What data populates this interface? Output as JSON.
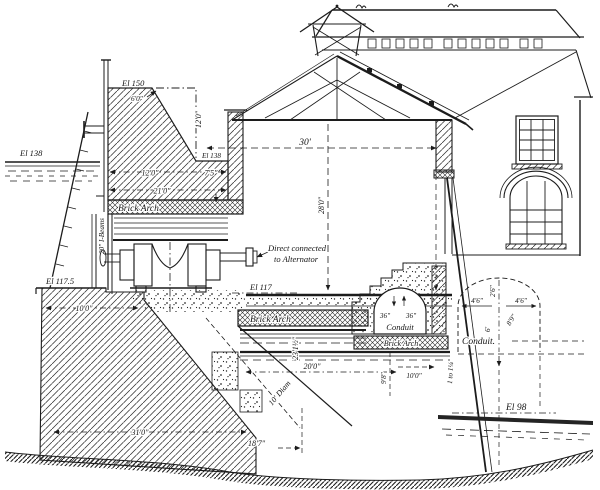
{
  "drawing": {
    "type": "engineering-cross-section",
    "description": "Sectional elevation of a hydroelectric power house with dam, turbine direct-connected to alternator, brick arches and tailrace conduits",
    "ink_color": "#1c1c1c",
    "paper_color": "#ffffff"
  },
  "labels": {
    "el_150": "El 150",
    "el_138_left": "El 138",
    "el_138_right": "El 138",
    "el_117_5": "El 117.5",
    "el_117": "El 117",
    "el_98": "El 98",
    "dim_crest_width": "6'0\"",
    "dim_crest_height": "12'0\"",
    "dim_wall_12": "12'0\"",
    "dim_wall_7_5": "7'5\"",
    "dim_wall_21": "21'0\"",
    "brick_arch_upper": "Brick Arch",
    "i_beams": "20\" I-Beams",
    "dim_base_10": "10'0\"",
    "alt_line1": "Direct connected",
    "alt_line2": "to Alternator",
    "dim_hall_width": "30'",
    "dim_hall_height": "28'0\"",
    "brick_arch_tail": "Brick Arch",
    "dim_tail_height": "23'1½\"",
    "dim_tail_width": "20'0\"",
    "conduit1_w": "36\"",
    "conduit1_h": "36\"",
    "conduit1": "Conduit",
    "brick_arch_conduit": "Brick Arch",
    "dim_9_8": "9'8\"",
    "dim_10_right": "10'0\"",
    "slope": "1 to 1¼",
    "conduit2": "Conduit.",
    "dim_c2_left": "4'6\"",
    "dim_c2_right": "4'6\"",
    "dim_c2_rise": "2'6\"",
    "dim_c2_height": "6'",
    "dim_c2_radius": "8'9\"",
    "dim_base_31": "31'0\"",
    "dim_18_7": "18'7\"",
    "dim_draft_diam": "10' Diam"
  }
}
